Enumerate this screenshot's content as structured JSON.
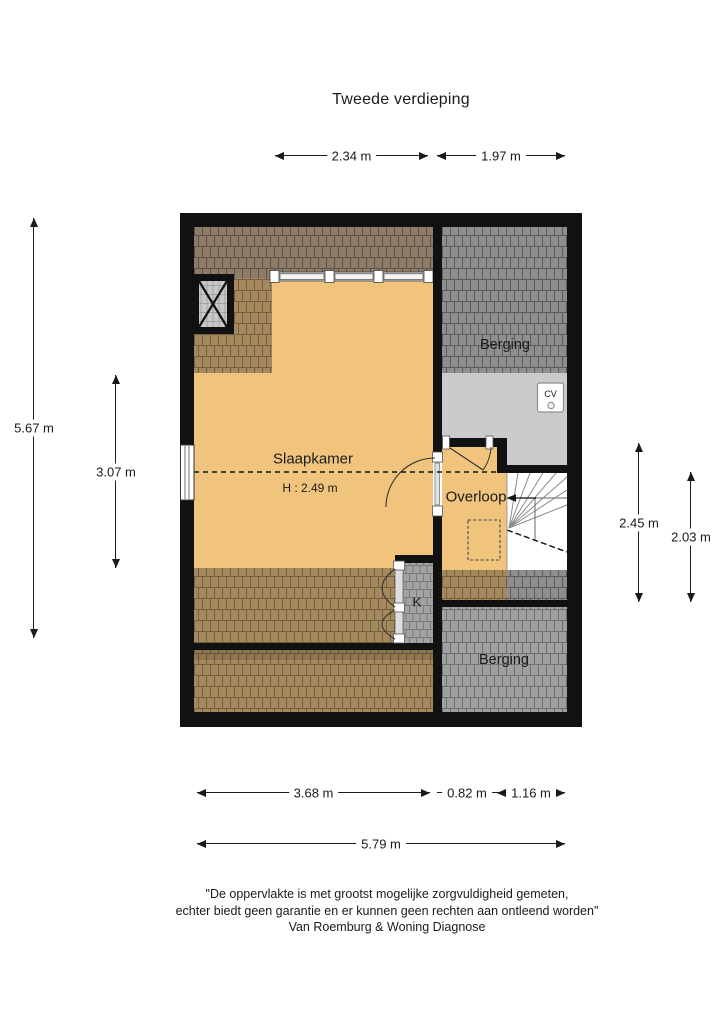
{
  "title": "Tweede verdieping",
  "floor_plan": {
    "rooms": {
      "slaapkamer": {
        "name": "Slaapkamer",
        "ceiling_height": "H : 2.49 m"
      },
      "berging_top": {
        "name": "Berging"
      },
      "overloop": {
        "name": "Overloop"
      },
      "closet": {
        "name": "K"
      },
      "berging_bottom": {
        "name": "Berging"
      },
      "cv_unit": {
        "name": "CV"
      }
    },
    "colors": {
      "floor_orange": "#f1c47d",
      "roof_tile_tan": "#a5895e",
      "roof_tile_brown": "#8d7c67",
      "roof_tile_dark_gray": "#8e8e8e",
      "roof_tile_mid_gray": "#9f9f9f",
      "floor_light_gray": "#cbcbcb",
      "wall_black": "#111111"
    }
  },
  "dimensions": {
    "top": [
      {
        "label": "2.34 m"
      },
      {
        "label": "1.97 m"
      }
    ],
    "left": [
      {
        "label": "5.67 m"
      },
      {
        "label": "3.07 m"
      }
    ],
    "right": [
      {
        "label": "2.45 m"
      },
      {
        "label": "2.03 m"
      }
    ],
    "bottom": [
      {
        "label": "3.68 m"
      },
      {
        "label": "0.82 m"
      },
      {
        "label": "1.16 m"
      },
      {
        "label": "5.79 m"
      }
    ]
  },
  "footer": {
    "line1": "\"De oppervlakte is met grootst mogelijke zorgvuldigheid gemeten,",
    "line2": "echter biedt geen garantie en er kunnen geen rechten aan ontleend worden\"",
    "line3": "Van Roemburg & Woning Diagnose"
  }
}
